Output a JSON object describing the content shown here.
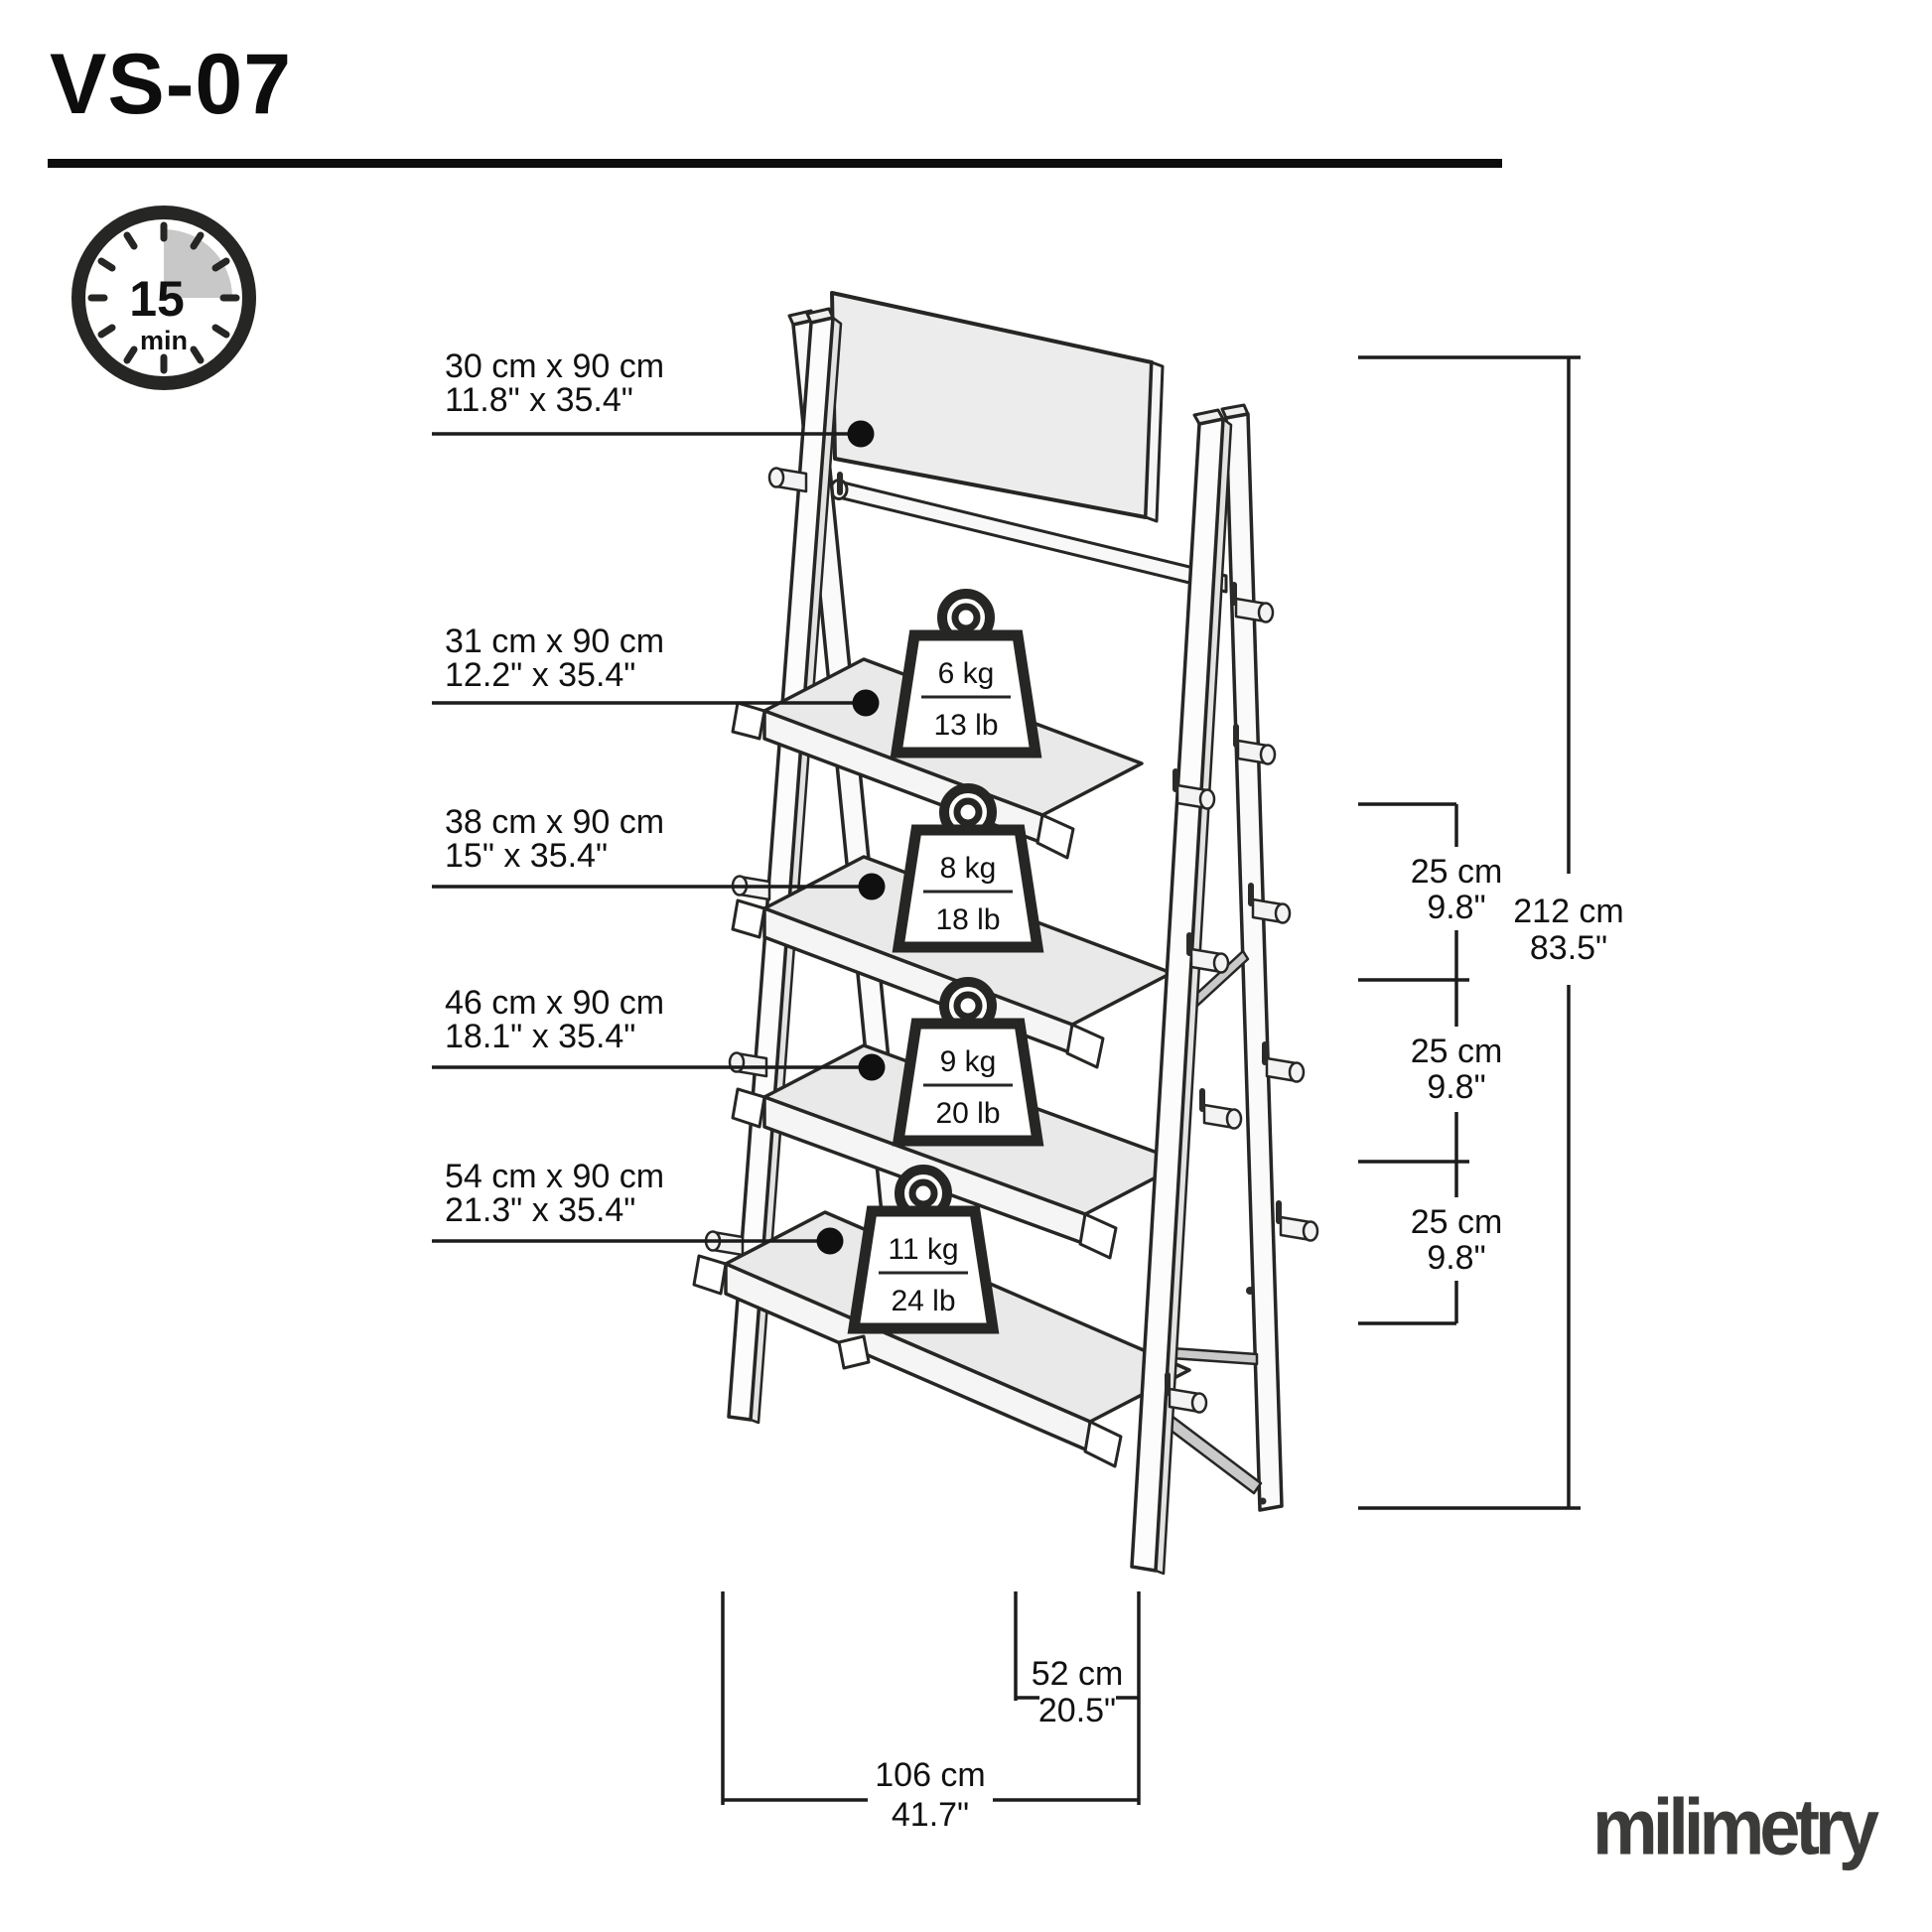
{
  "header": {
    "title": "VS-07"
  },
  "assembly_time": {
    "minutes": "15",
    "unit": "min"
  },
  "shelf_labels": [
    {
      "metric": "30 cm x 90 cm",
      "imperial": "11.8\" x 35.4\""
    },
    {
      "metric": "31 cm x 90 cm",
      "imperial": "12.2\" x 35.4\""
    },
    {
      "metric": "38 cm x 90 cm",
      "imperial": "15\" x 35.4\""
    },
    {
      "metric": "46 cm x 90 cm",
      "imperial": "18.1\" x 35.4\""
    },
    {
      "metric": "54 cm x 90 cm",
      "imperial": "21.3\" x 35.4\""
    }
  ],
  "load_capacities": [
    {
      "kg": "6 kg",
      "lb": "13 lb"
    },
    {
      "kg": "8 kg",
      "lb": "18 lb"
    },
    {
      "kg": "9 kg",
      "lb": "20 lb"
    },
    {
      "kg": "11 kg",
      "lb": "24 lb"
    }
  ],
  "dimensions": {
    "total_height": {
      "metric": "212 cm",
      "imperial": "83.5\""
    },
    "shelf_spacing": [
      {
        "metric": "25 cm",
        "imperial": "9.8\""
      },
      {
        "metric": "25 cm",
        "imperial": "9.8\""
      },
      {
        "metric": "25 cm",
        "imperial": "9.8\""
      }
    ],
    "depth": {
      "metric": "52 cm",
      "imperial": "20.5\""
    },
    "width": {
      "metric": "106 cm",
      "imperial": "41.7\""
    }
  },
  "brand": {
    "logo_text": "milimetry"
  },
  "colors": {
    "line": "#262624",
    "panel": "#ececec",
    "shelf": "#e9e9e9",
    "shadow": "#d5d5d5",
    "brace": "#c9c9c9",
    "sector": "#c8c8c8"
  }
}
